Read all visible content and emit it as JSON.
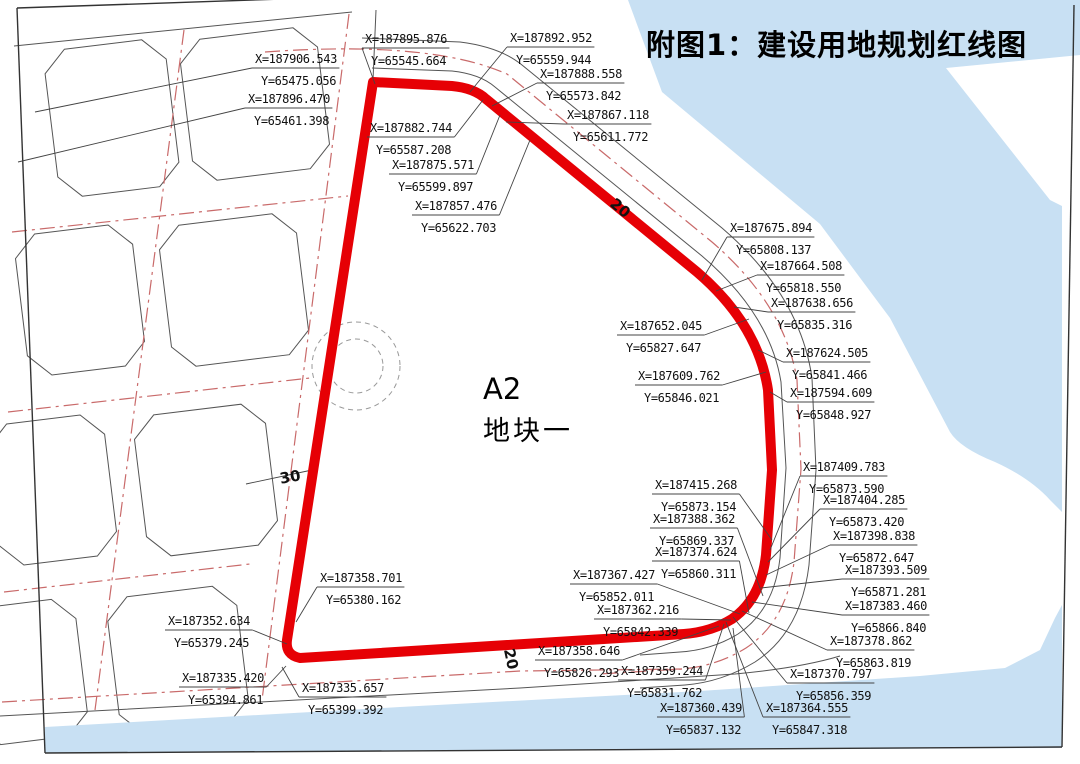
{
  "title": "附图1：建设用地规划红线图",
  "parcel": {
    "code": "A2",
    "name": "地块一"
  },
  "colors": {
    "red_line": "#e60005",
    "road_centerline_red": "#c96a6a",
    "water_blue": "#c8e0f3",
    "line_black": "#444444"
  },
  "dimension_labels": [
    {
      "text": "30",
      "x": 291,
      "y": 482,
      "rot": -10
    },
    {
      "text": "20",
      "x": 617,
      "y": 212,
      "rot": 40
    },
    {
      "text": "20",
      "x": 506,
      "y": 660,
      "rot": 78
    }
  ],
  "coordinate_labels": [
    {
      "x_text": "X=187906.543",
      "y_text": "Y=65475.056",
      "tx": 255,
      "ty": 63,
      "px": 35,
      "py": 112
    },
    {
      "x_text": "X=187895.876",
      "y_text": "Y=65545.664",
      "tx": 365,
      "ty": 43,
      "px": 375,
      "py": 84
    },
    {
      "x_text": "X=187892.952",
      "y_text": "Y=65559.944",
      "tx": 510,
      "ty": 42,
      "px": 470,
      "py": 92
    },
    {
      "x_text": "X=187888.558",
      "y_text": "Y=65573.842",
      "tx": 540,
      "ty": 78,
      "px": 492,
      "py": 106
    },
    {
      "x_text": "X=187896.470",
      "y_text": "Y=65461.398",
      "tx": 248,
      "ty": 103,
      "px": 18,
      "py": 162
    },
    {
      "x_text": "X=187882.744",
      "y_text": "Y=65587.208",
      "tx": 370,
      "ty": 132,
      "px": 483,
      "py": 100
    },
    {
      "x_text": "X=187875.571",
      "y_text": "Y=65599.897",
      "tx": 392,
      "ty": 169,
      "px": 500,
      "py": 115
    },
    {
      "x_text": "X=187857.476",
      "y_text": "Y=65622.703",
      "tx": 415,
      "ty": 210,
      "px": 530,
      "py": 140
    },
    {
      "x_text": "X=187867.118",
      "y_text": "Y=65611.772",
      "tx": 567,
      "ty": 119,
      "px": 506,
      "py": 122
    },
    {
      "x_text": "X=187675.894",
      "y_text": "Y=65808.137",
      "tx": 730,
      "ty": 232,
      "px": 702,
      "py": 280
    },
    {
      "x_text": "X=187664.508",
      "y_text": "Y=65818.550",
      "tx": 760,
      "ty": 270,
      "px": 716,
      "py": 291
    },
    {
      "x_text": "X=187638.656",
      "y_text": "Y=65835.316",
      "tx": 771,
      "ty": 307,
      "px": 734,
      "py": 307
    },
    {
      "x_text": "X=187652.045",
      "y_text": "Y=65827.647",
      "tx": 620,
      "ty": 330,
      "px": 749,
      "py": 319
    },
    {
      "x_text": "X=187624.505",
      "y_text": "Y=65841.466",
      "tx": 786,
      "ty": 357,
      "px": 758,
      "py": 350
    },
    {
      "x_text": "X=187609.762",
      "y_text": "Y=65846.021",
      "tx": 638,
      "ty": 380,
      "px": 766,
      "py": 372
    },
    {
      "x_text": "X=187594.609",
      "y_text": "Y=65848.927",
      "tx": 790,
      "ty": 397,
      "px": 770,
      "py": 392
    },
    {
      "x_text": "X=187415.268",
      "y_text": "Y=65873.154",
      "tx": 655,
      "ty": 489,
      "px": 772,
      "py": 540
    },
    {
      "x_text": "X=187388.362",
      "y_text": "Y=65869.337",
      "tx": 653,
      "ty": 523,
      "px": 763,
      "py": 596
    },
    {
      "x_text": "X=187374.624",
      "y_text": "Y=65860.311",
      "tx": 655,
      "ty": 556,
      "px": 749,
      "py": 613
    },
    {
      "x_text": "X=187409.783",
      "y_text": "Y=65873.590",
      "tx": 803,
      "ty": 471,
      "px": 770,
      "py": 550
    },
    {
      "x_text": "X=187404.285",
      "y_text": "Y=65873.420",
      "tx": 823,
      "ty": 504,
      "px": 768,
      "py": 562
    },
    {
      "x_text": "X=187398.838",
      "y_text": "Y=65872.647",
      "tx": 833,
      "ty": 540,
      "px": 766,
      "py": 575
    },
    {
      "x_text": "X=187393.509",
      "y_text": "Y=65871.281",
      "tx": 845,
      "ty": 574,
      "px": 761,
      "py": 588
    },
    {
      "x_text": "X=187383.460",
      "y_text": "Y=65866.840",
      "tx": 845,
      "ty": 610,
      "px": 752,
      "py": 602
    },
    {
      "x_text": "X=187378.862",
      "y_text": "Y=65863.819",
      "tx": 830,
      "ty": 645,
      "px": 742,
      "py": 611
    },
    {
      "x_text": "X=187370.797",
      "y_text": "Y=65856.359",
      "tx": 790,
      "ty": 678,
      "px": 733,
      "py": 617
    },
    {
      "x_text": "X=187364.555",
      "y_text": "Y=65847.318",
      "tx": 766,
      "ty": 712,
      "px": 726,
      "py": 622
    },
    {
      "x_text": "X=187367.427",
      "y_text": "Y=65852.011",
      "tx": 573,
      "ty": 579,
      "px": 740,
      "py": 614
    },
    {
      "x_text": "X=187362.216",
      "y_text": "Y=65842.339",
      "tx": 597,
      "ty": 614,
      "px": 731,
      "py": 620
    },
    {
      "x_text": "X=187358.646",
      "y_text": "Y=65826.293",
      "tx": 538,
      "ty": 655,
      "px": 719,
      "py": 626
    },
    {
      "x_text": "X=187359.244",
      "y_text": "Y=65831.762",
      "tx": 621,
      "ty": 675,
      "px": 724,
      "py": 624
    },
    {
      "x_text": "X=187360.439",
      "y_text": "Y=65837.132",
      "tx": 660,
      "ty": 712,
      "px": 733,
      "py": 628
    },
    {
      "x_text": "X=187358.701",
      "y_text": "Y=65380.162",
      "tx": 320,
      "ty": 582,
      "px": 296,
      "py": 622
    },
    {
      "x_text": "X=187352.634",
      "y_text": "Y=65379.245",
      "tx": 168,
      "ty": 625,
      "px": 287,
      "py": 644
    },
    {
      "x_text": "X=187335.420",
      "y_text": "Y=65394.861",
      "tx": 182,
      "ty": 682,
      "px": 286,
      "py": 666
    },
    {
      "x_text": "X=187335.657",
      "y_text": "Y=65399.392",
      "tx": 302,
      "ty": 692,
      "px": 282,
      "py": 667
    }
  ]
}
